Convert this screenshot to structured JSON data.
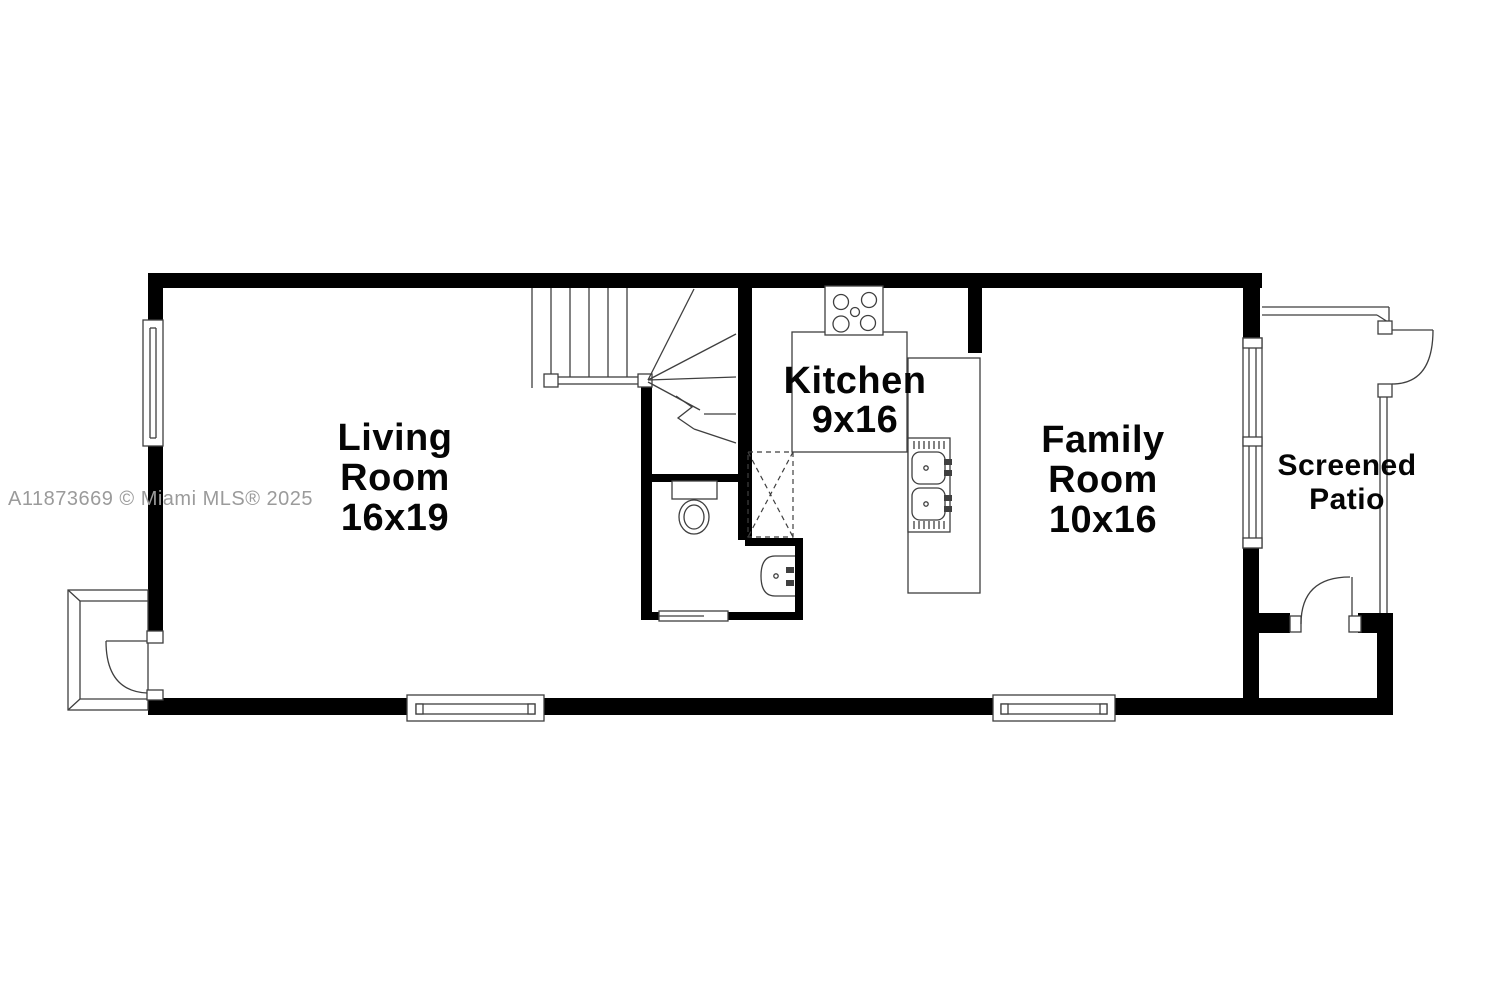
{
  "watermark": {
    "text": "A11873669 © Miami MLS® 2025"
  },
  "rooms": {
    "living": {
      "name_line1": "Living",
      "name_line2": "Room",
      "dimensions": "16x19"
    },
    "kitchen": {
      "name_line1": "Kitchen",
      "dimensions": "9x16"
    },
    "family": {
      "name_line1": "Family",
      "name_line2": "Room",
      "dimensions": "10x16"
    },
    "patio": {
      "name_line1": "Screened",
      "name_line2": "Patio"
    }
  },
  "colors": {
    "background": "#ffffff",
    "wall": "#000000",
    "line": "#3f3f3f",
    "label": "#050505",
    "watermark": "#9b9b9b"
  }
}
